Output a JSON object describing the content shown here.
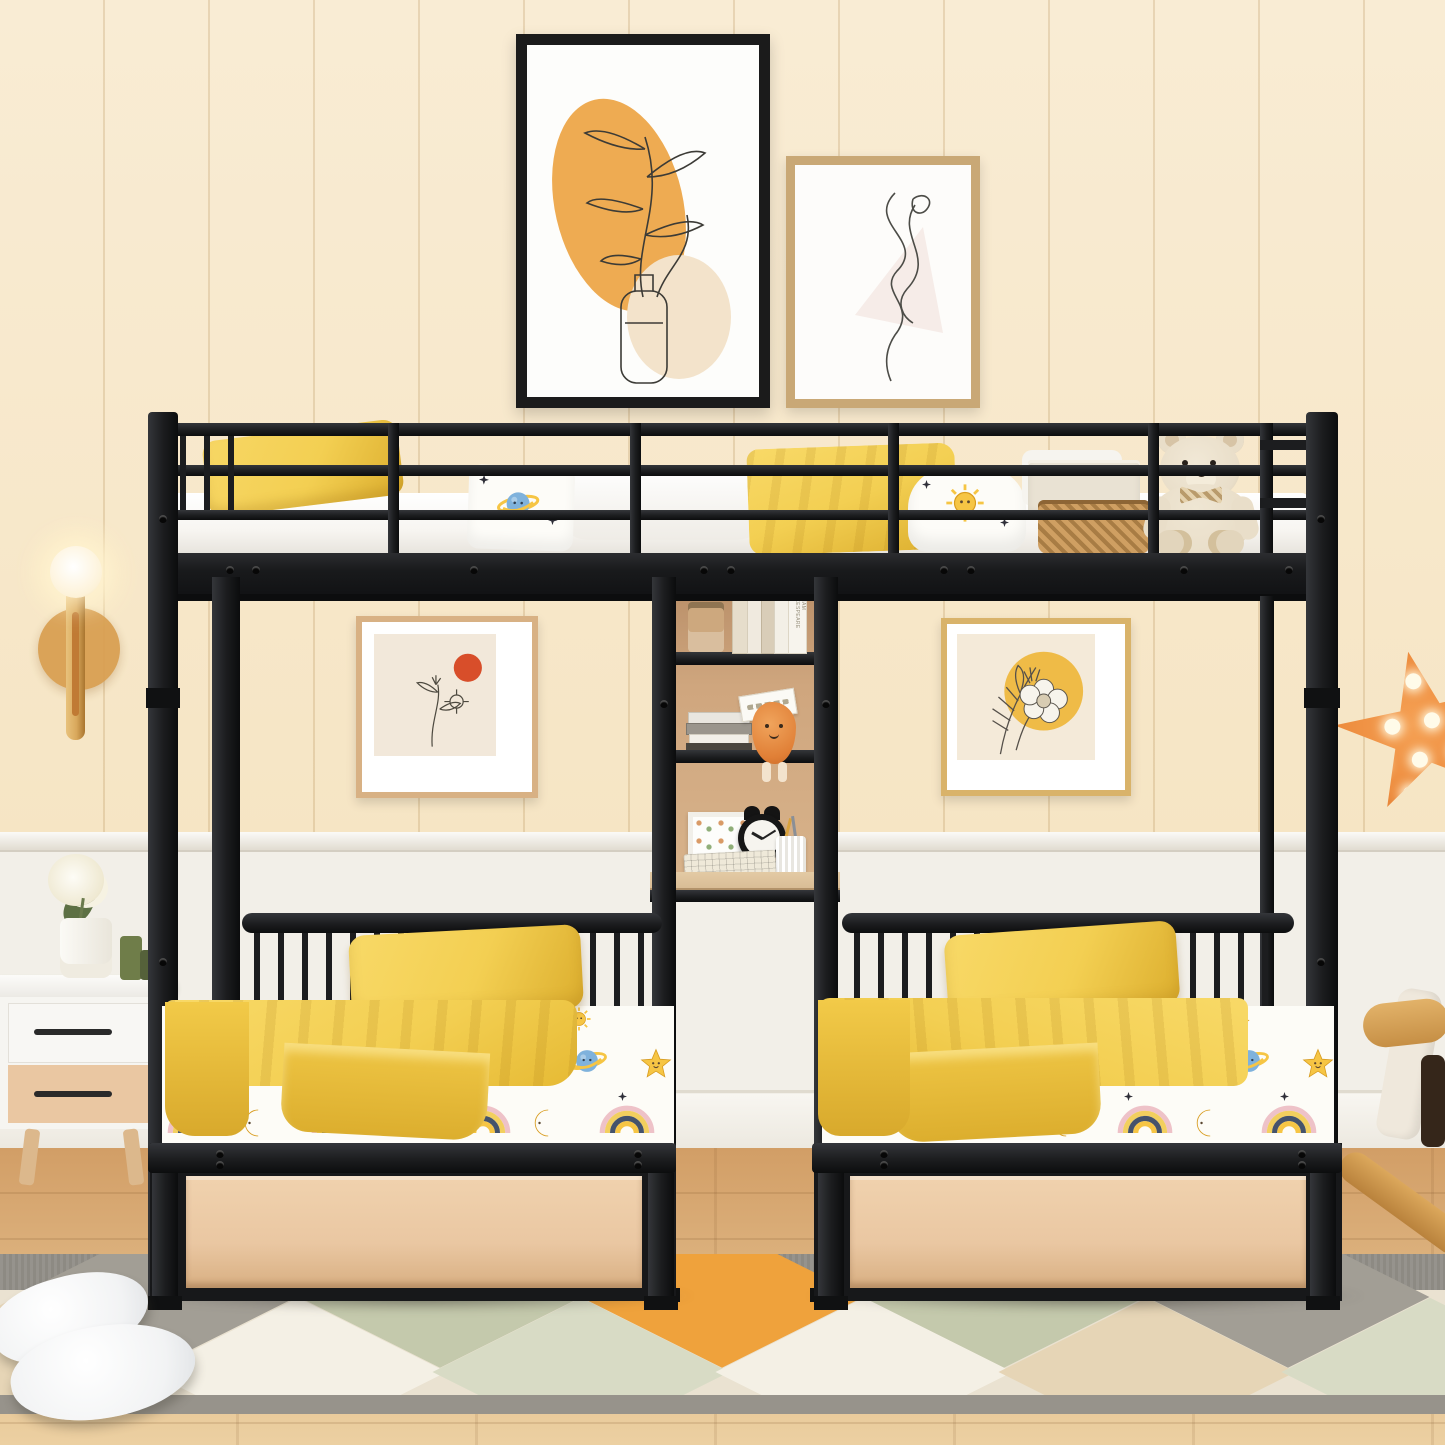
{
  "image": {
    "description": "Product photograph of a black metal triple bunk bed: a full-size loft bed on top over two twin beds with wood storage drawers, separated by a built-in shelf and desk tower, in a cream wood-paneled kids bedroom",
    "style": "photograph"
  },
  "text": {
    "book_spine": "WILLIAM SHAKESPEARE"
  },
  "alarm_clock": {
    "time": "10:10"
  },
  "objects": [
    "bunk bed frame",
    "guard rails",
    "ladder",
    "shelf desk tower",
    "twin mattresses with star and planet sheets",
    "yellow pillows",
    "yellow blankets",
    "teddy bear",
    "wicker basket",
    "fabric storage box",
    "wall sconce",
    "orange star marquee lamp",
    "abstract botanical print",
    "line figure print",
    "moon and sun print",
    "flower and sun print",
    "white nightstand",
    "vase with white flower",
    "green candlesticks",
    "alarm clock",
    "keyboard",
    "pencil cup",
    "photo frame",
    "books",
    "plush slippers",
    "diamond pattern rug",
    "wooden rocking toy"
  ],
  "palette": {
    "wall": "#f8e9cd",
    "wainscot": "#f2efe8",
    "floorDark": "#d29e66",
    "floorLight": "#ecd0a2",
    "rugBase": "#eae2d1",
    "rugBand": "#8d8a83",
    "rugOrange": "#efa23c",
    "rugSage": "#c4c9ac",
    "rugGray": "#a29e95",
    "rugBeige": "#e6d5b6",
    "rugWhite": "#f4f0e5",
    "rugSageLight": "#d8dbc5",
    "metal": "#1c1d1f",
    "metalLight": "#34363a",
    "mattress": "#f7f5f1",
    "yellow": "#f3cf52",
    "yellowDeep": "#dcae2e",
    "drawerWood": "#eac7a2",
    "shelfWood": "#c79d77",
    "deskWood": "#d9bd96",
    "teddy": "#e9dec9",
    "teddyDark": "#d7c4a6",
    "wicker": "#c0925a",
    "linen": "#e9e2d3",
    "starOrange": "#ed8c3e",
    "starOrangeDark": "#cf6d28",
    "gold": "#d9a85c",
    "amberDisc": "#d89e4f",
    "artOrange": "#eeab52",
    "artRed": "#d84e2a",
    "artYellow": "#eeb83f",
    "sheetYellow": "#f6c544",
    "sheetBlue": "#7fb2dc",
    "sheetNavy": "#45536b",
    "sheetPink": "#eec2c8",
    "frameBlack": "#1b1b1b",
    "frameTan": "#c9a876",
    "frameGold": "#d9b36a",
    "candleGreen": "#6f7d49"
  }
}
